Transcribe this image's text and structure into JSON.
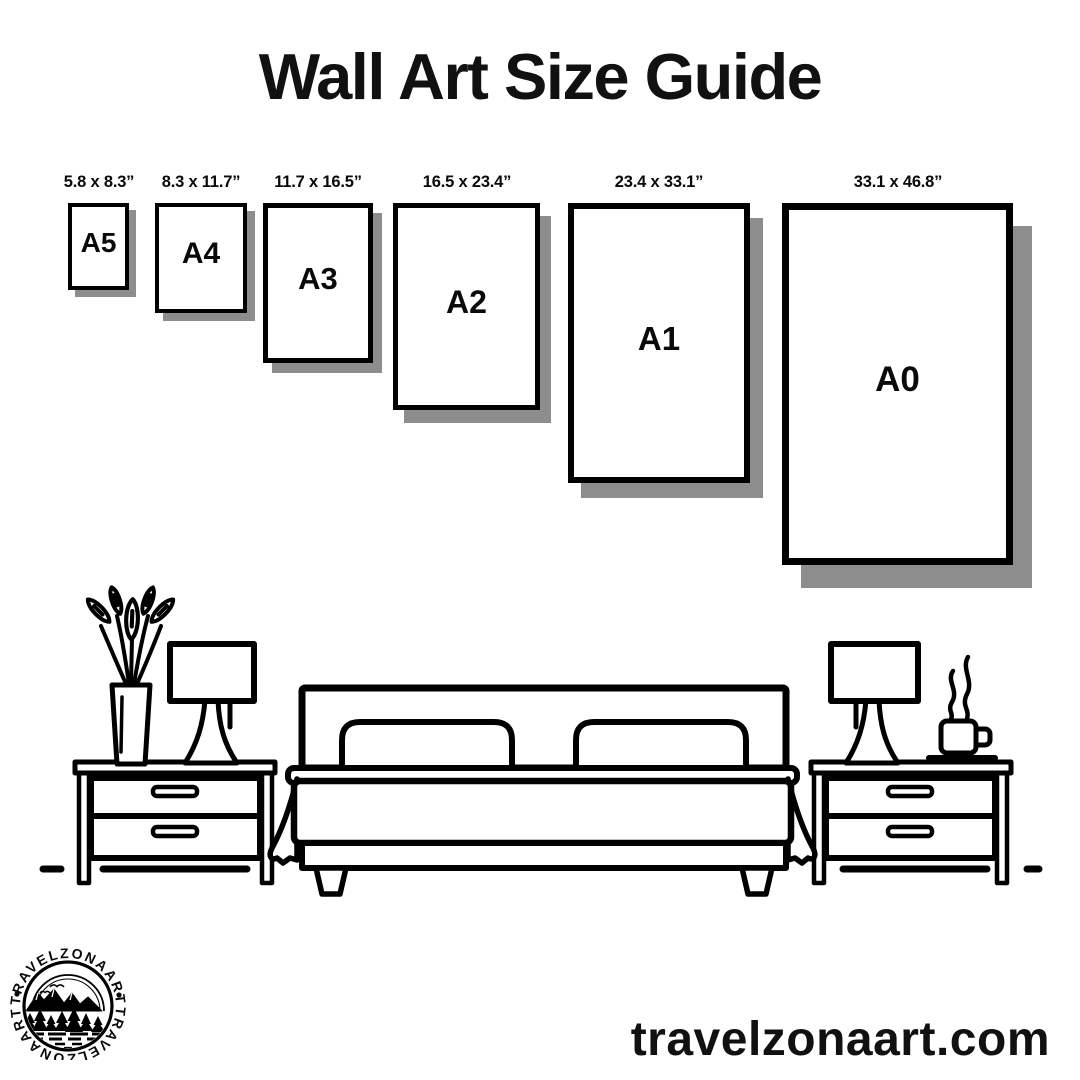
{
  "title": "Wall Art Size Guide",
  "sizes": [
    {
      "code": "A5",
      "dimensions": "5.8 x 8.3”"
    },
    {
      "code": "A4",
      "dimensions": "8.3 x 11.7”"
    },
    {
      "code": "A3",
      "dimensions": "11.7 x 16.5”"
    },
    {
      "code": "A2",
      "dimensions": "16.5 x 23.4”"
    },
    {
      "code": "A1",
      "dimensions": "23.4 x 33.1”"
    },
    {
      "code": "A0",
      "dimensions": "33.1 x 46.8”"
    }
  ],
  "footer": {
    "website": "travelzonaart.com"
  },
  "logo": {
    "brand_top": "TRAVELZONAART",
    "brand_bottom": "TRAVELZONAART"
  },
  "colors": {
    "ink": "#000000",
    "poster_shadow": "#8d8d8d",
    "background": "#ffffff"
  },
  "illustration_elements": [
    "plant-vase",
    "table-lamp-left",
    "nightstand-left",
    "double-bed",
    "nightstand-right",
    "table-lamp-right",
    "coffee-cup",
    "floor-line"
  ]
}
